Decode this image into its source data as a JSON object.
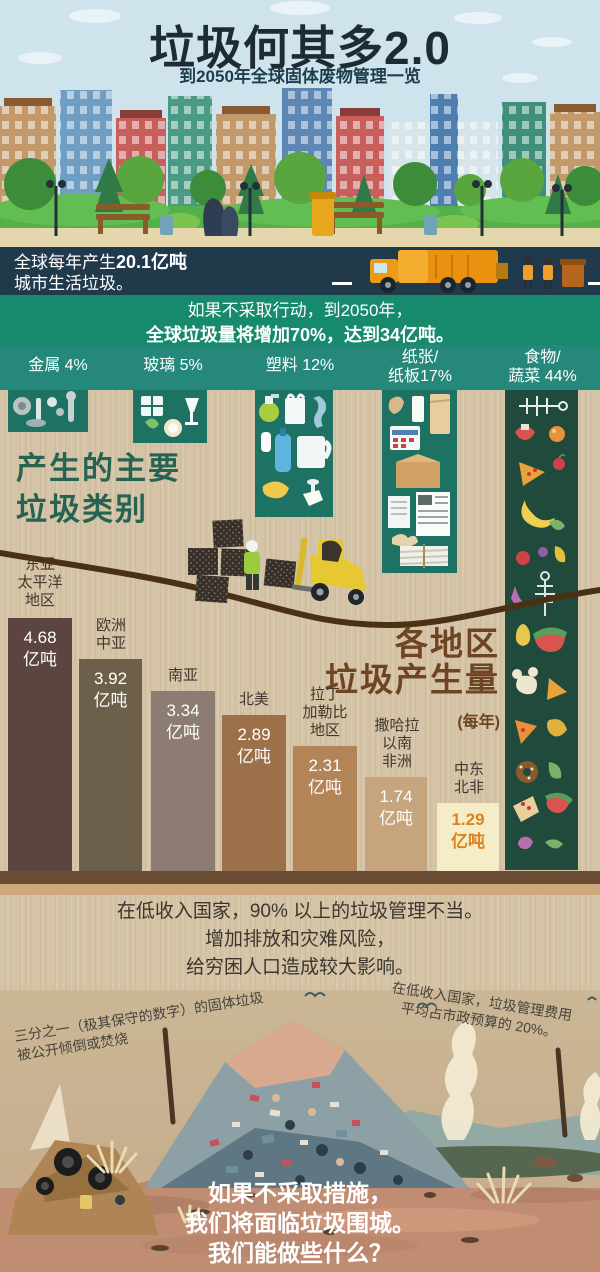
{
  "header": {
    "title": "垃圾何其多2.0",
    "subtitle": "到2050年全球固体废物管理一览"
  },
  "stats_banner": {
    "prefix": "全球每年产生",
    "amount": "20.1亿吨",
    "line2": "城市生活垃圾。"
  },
  "warning_banner": {
    "line1": "如果不采取行动，到2050年，",
    "line2": "全球垃圾量将增加70%，达到34亿吨。"
  },
  "categories": {
    "section_title_line1": "产生的主要",
    "section_title_line2": "垃圾类别",
    "items": [
      {
        "label": "金属 4%"
      },
      {
        "label": "玻璃 5%"
      },
      {
        "label": "塑料 12%"
      },
      {
        "label": "纸张/",
        "label2": "纸板17%"
      },
      {
        "label": "食物/",
        "label2": "蔬菜 44%"
      }
    ]
  },
  "chart": {
    "title_line1": "各地区",
    "title_line2": "垃圾产生量",
    "subtitle": "(每年)",
    "unit_label": "亿吨",
    "bars": [
      {
        "region_lines": [
          "东亚",
          "太平洋",
          "地区"
        ],
        "value": "4.68"
      },
      {
        "region_lines": [
          "欧洲",
          "中亚"
        ],
        "value": "3.92"
      },
      {
        "region_lines": [
          "南亚"
        ],
        "value": "3.34"
      },
      {
        "region_lines": [
          "北美"
        ],
        "value": "2.89"
      },
      {
        "region_lines": [
          "拉丁",
          "加勒比",
          "地区"
        ],
        "value": "2.31"
      },
      {
        "region_lines": [
          "撒哈拉",
          "以南",
          "非洲"
        ],
        "value": "1.74"
      },
      {
        "region_lines": [
          "中东",
          "北非"
        ],
        "value": "1.29"
      }
    ]
  },
  "impact": {
    "lines": [
      "在低收入国家，90% 以上的垃圾管理不当。",
      "增加排放和灾难风险，",
      "给穷困人口造成较大影响。"
    ]
  },
  "annotations": {
    "left_line1": "三分之一（极其保守的数字）的固体垃圾",
    "left_line2": "被公开倾倒或焚烧",
    "right_line1": "在低收入国家，垃圾管理费用",
    "right_line2": "平均占市政预算的 20%。"
  },
  "footer": {
    "lines": [
      "如果不采取措施，",
      "我们将面临垃圾围城。",
      "我们能做些什么？"
    ]
  },
  "colors": {
    "navy_banner": "#203a4c",
    "teal_banner": "#17896c",
    "category_band": "#26877b",
    "tile_green": "#1e7263",
    "food_column_green": "#1f4a3c",
    "burlap": "#d4c3a5",
    "bar_darkest": "#5c4541",
    "bar_lightest": "#f4edc8",
    "highlight_value": "#e0811c"
  },
  "chart_data": [
    {
      "type": "bar",
      "title": "各地区垃圾产生量(每年)",
      "categories": [
        "东亚太平洋地区",
        "欧洲中亚",
        "南亚",
        "北美",
        "拉丁加勒比地区",
        "撒哈拉以南非洲",
        "中东北非"
      ],
      "values": [
        4.68,
        3.92,
        3.34,
        2.89,
        2.31,
        1.74,
        1.29
      ],
      "unit": "亿吨",
      "ylabel": "亿吨",
      "ylim": [
        0,
        5
      ],
      "legend": "none",
      "grid": false
    },
    {
      "type": "bar",
      "title": "产生的主要垃圾类别",
      "categories": [
        "金属",
        "玻璃",
        "塑料",
        "纸张/纸板",
        "食物/蔬菜"
      ],
      "values": [
        4,
        5,
        12,
        17,
        44
      ],
      "unit": "%",
      "note": "全球每年产生20.1亿吨城市生活垃圾；如果不采取行动，到2050年全球垃圾量将增加70%，达到34亿吨"
    }
  ]
}
